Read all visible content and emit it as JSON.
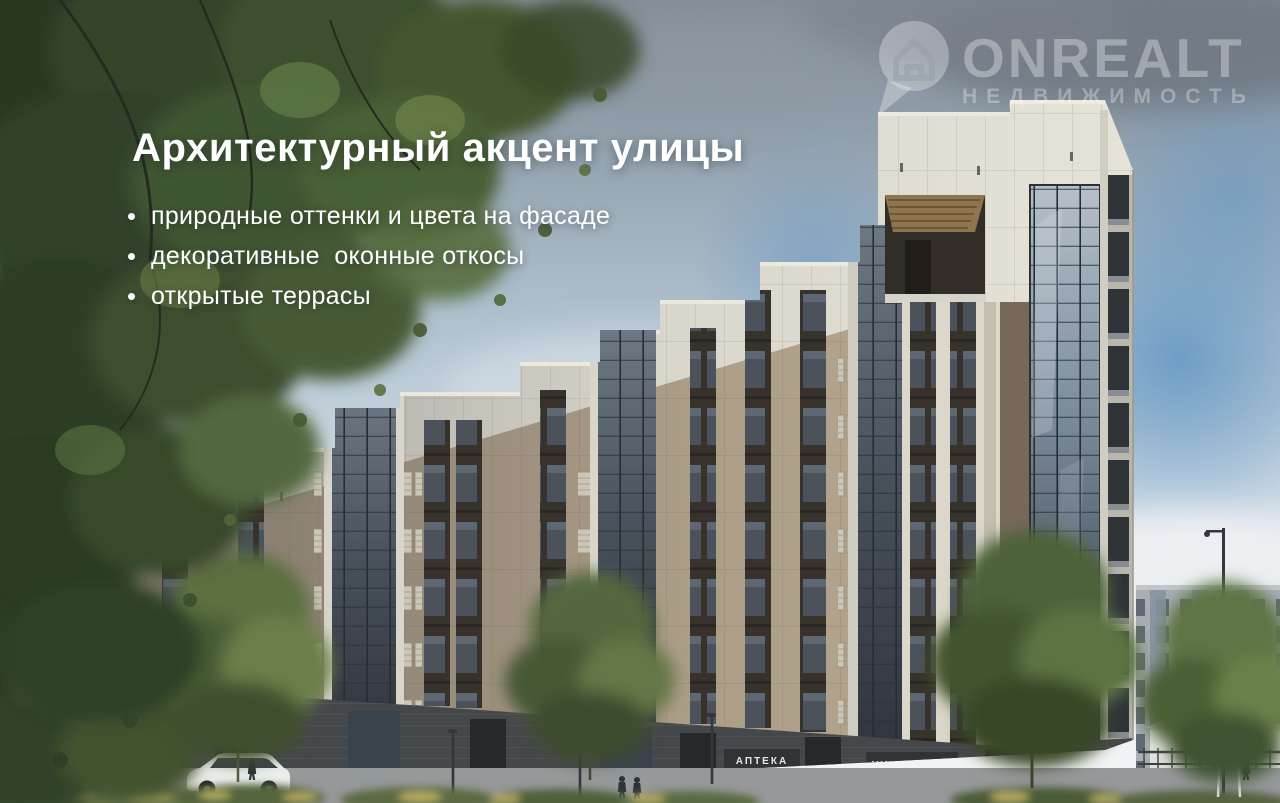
{
  "page": {
    "kind": "real-estate presentation slide over architectural render",
    "width": 1280,
    "height": 803
  },
  "overlay": {
    "title": "Архитектурный акцент улицы",
    "bullets": [
      "природные оттенки и цвета на фасаде",
      "декоративные  оконные откосы",
      "открытые террасы"
    ]
  },
  "logo": {
    "brand": "ONREALT",
    "tagline": "НЕДВИЖИМОСТЬ",
    "icon": "house-pin-icon",
    "opacity": "0.33"
  },
  "signs": {
    "pharmacy": "АПТЕКА",
    "supermarket": "УНИВЕРСАМ"
  },
  "colors": {
    "facade_white": "#ddd9cd",
    "facade_beige": "#ab9c87",
    "facade_taupe": "#77695a",
    "ground_floor": "#45484b",
    "glass_curtain": "#55616e",
    "sky_blue": "#6699c4",
    "foliage_dark": "#2f3d27",
    "foliage_light": "#6a8148",
    "overlay_text": "#ffffff"
  }
}
